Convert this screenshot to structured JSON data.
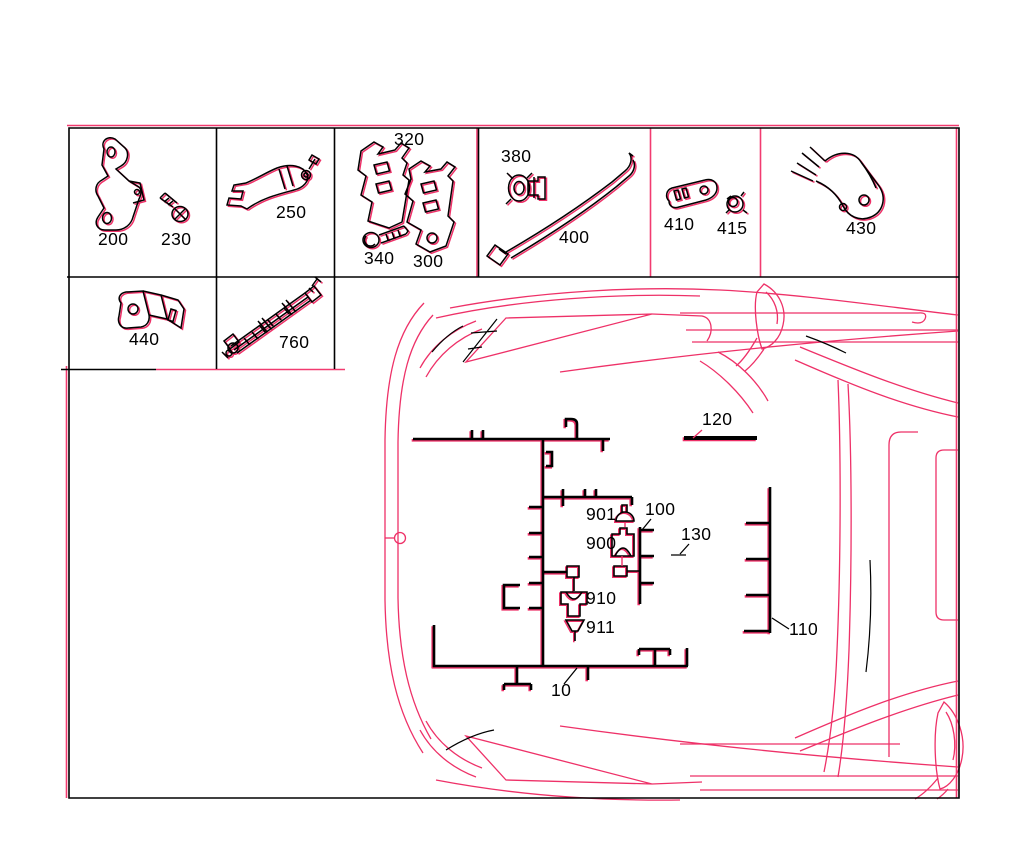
{
  "colors": {
    "line": "#000000",
    "accent": "#ee3168",
    "highlight": "#f23b70",
    "background": "#ffffff"
  },
  "parts_grid": {
    "row1": [
      {
        "cell_id": "cell-200-230",
        "highlighted": false,
        "parts": [
          {
            "no": "200"
          },
          {
            "no": "230"
          }
        ]
      },
      {
        "cell_id": "cell-250",
        "highlighted": false,
        "parts": [
          {
            "no": "250"
          }
        ]
      },
      {
        "cell_id": "cell-320-340-300",
        "highlighted": false,
        "parts": [
          {
            "no": "320"
          },
          {
            "no": "340"
          },
          {
            "no": "300"
          }
        ]
      },
      {
        "cell_id": "cell-380-400",
        "highlighted": false,
        "parts": [
          {
            "no": "380"
          },
          {
            "no": "400"
          }
        ]
      },
      {
        "cell_id": "cell-410-415",
        "highlighted": true,
        "parts": [
          {
            "no": "410"
          },
          {
            "no": "415"
          }
        ]
      },
      {
        "cell_id": "cell-430",
        "highlighted": false,
        "parts": [
          {
            "no": "430"
          }
        ]
      }
    ],
    "row2": [
      {
        "cell_id": "cell-440",
        "highlighted": false,
        "parts": [
          {
            "no": "440"
          }
        ]
      },
      {
        "cell_id": "cell-760",
        "highlighted": false,
        "parts": [
          {
            "no": "760"
          }
        ]
      }
    ]
  },
  "diagram": {
    "callouts": [
      {
        "no": "120"
      },
      {
        "no": "100"
      },
      {
        "no": "901"
      },
      {
        "no": "900"
      },
      {
        "no": "130"
      },
      {
        "no": "910"
      },
      {
        "no": "911"
      },
      {
        "no": "10"
      },
      {
        "no": "110"
      }
    ]
  }
}
